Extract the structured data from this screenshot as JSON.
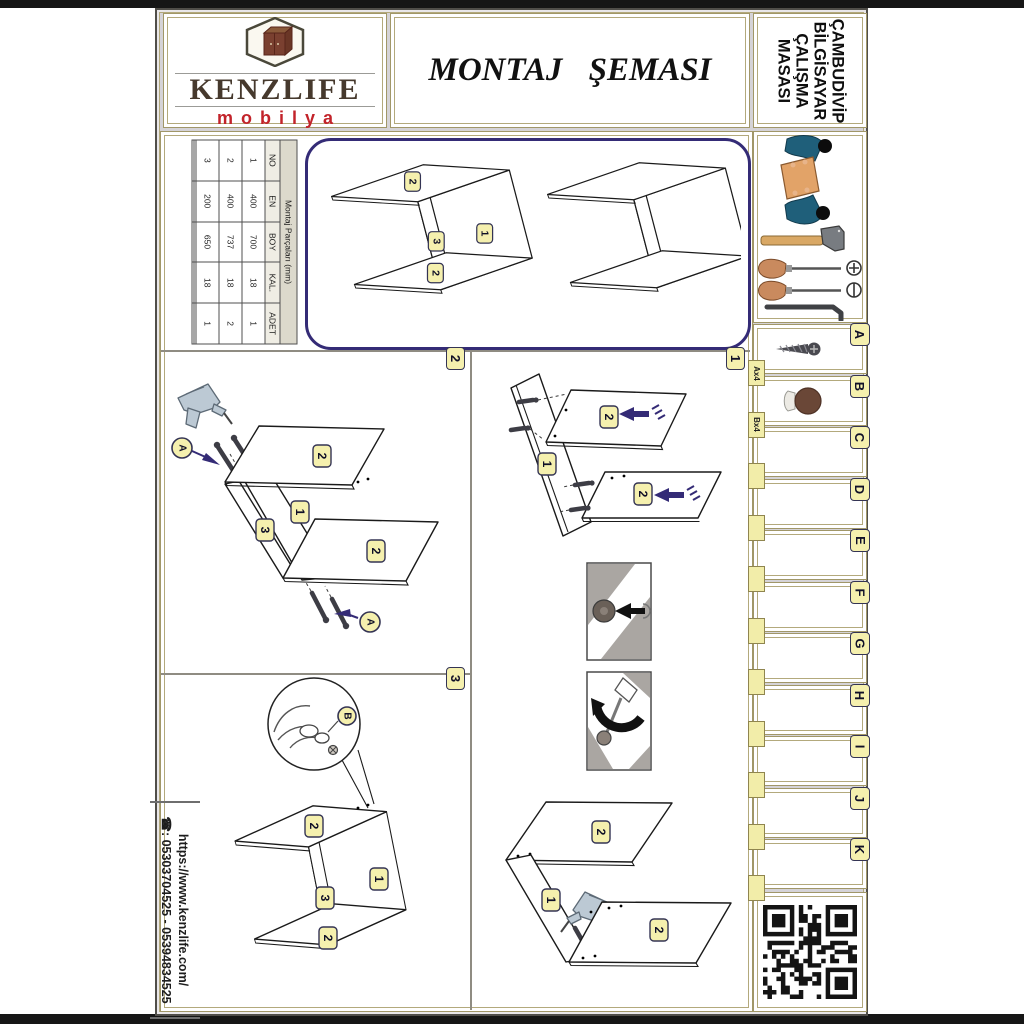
{
  "page": {
    "title": "MONTAJ ŞEMASI"
  },
  "brand": {
    "name": "KENZLIFE",
    "subtitle": "mobilya"
  },
  "product": {
    "lines": [
      "ÇAMBUDİVİP",
      "BİLGİSAYAR",
      "ÇALIŞMA",
      "MASASI"
    ]
  },
  "parts_table": {
    "title": "Montaj Parçaları (mm)",
    "headers": [
      "NO",
      "EN",
      "BOY",
      "KAL.",
      "ADET"
    ],
    "rows": [
      [
        "1",
        "400",
        "700",
        "18",
        "1"
      ],
      [
        "2",
        "400",
        "737",
        "18",
        "2"
      ],
      [
        "3",
        "200",
        "650",
        "18",
        "1"
      ],
      [
        "",
        "",
        "",
        "",
        ""
      ],
      [
        "",
        "",
        "",
        "",
        ""
      ]
    ]
  },
  "steps": {
    "s1": "1",
    "s2": "2",
    "s3": "3"
  },
  "panel_labels": {
    "p1": "1",
    "p2": "2",
    "p3": "3"
  },
  "hardware_labels": {
    "a": "A",
    "b": "B"
  },
  "sidebar": {
    "parts": [
      {
        "letter": "A",
        "tab": "Ax4",
        "icon": "screw-icon"
      },
      {
        "letter": "B",
        "tab": "Bx4",
        "icon": "cap-icon"
      },
      {
        "letter": "C",
        "tab": ""
      },
      {
        "letter": "D",
        "tab": ""
      },
      {
        "letter": "E",
        "tab": ""
      },
      {
        "letter": "F",
        "tab": ""
      },
      {
        "letter": "G",
        "tab": ""
      },
      {
        "letter": "H",
        "tab": ""
      },
      {
        "letter": "I",
        "tab": ""
      },
      {
        "letter": "J",
        "tab": ""
      },
      {
        "letter": "K",
        "tab": ""
      }
    ],
    "tools": [
      "hammer-icon",
      "phillips-screwdriver-icon",
      "flathead-screwdriver-icon",
      "allen-key-icon"
    ]
  },
  "contact": {
    "phone_icon": "☎",
    "phone": ": 05303704525 - 05394834525",
    "website": "https://www.kenzlife.com/"
  },
  "colors": {
    "accent_purple": "#342b76",
    "badge_yellow": "#f5f0ae",
    "brand_red": "#c2232a",
    "frame_khaki": "#b3a97c"
  }
}
